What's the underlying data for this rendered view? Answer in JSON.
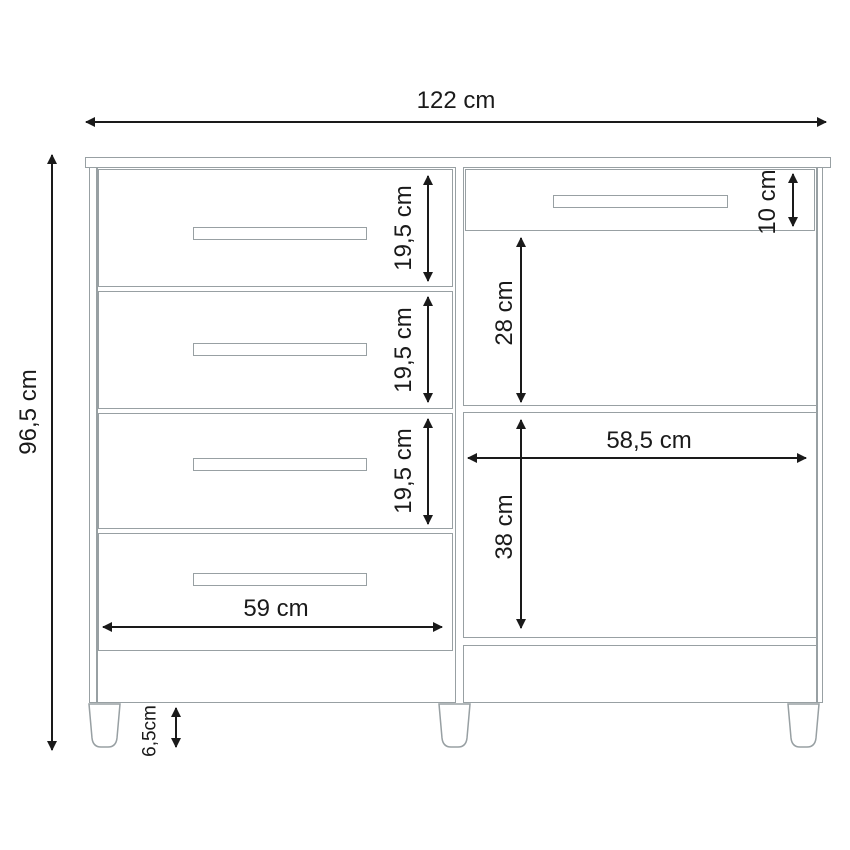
{
  "diagram": {
    "type": "furniture-dimension-drawing",
    "subject": "dresser front elevation with dimensions",
    "unit": "cm",
    "colors": {
      "outline": "#98a0a3",
      "dimension": "#1a1a1a",
      "background": "#ffffff"
    },
    "parts": {
      "left_drawers": 4,
      "right_top_drawers": 1,
      "open_compartments": 2,
      "shelves": 2,
      "feet": 3,
      "handles": 5
    },
    "dimensions": [
      {
        "id": "total-width",
        "label": "122 cm",
        "value": 122,
        "orientation": "horizontal"
      },
      {
        "id": "total-height",
        "label": "96,5 cm",
        "value": 96.5,
        "orientation": "vertical"
      },
      {
        "id": "left-drawer-1-height",
        "label": "19,5 cm",
        "value": 19.5,
        "orientation": "vertical"
      },
      {
        "id": "left-drawer-2-height",
        "label": "19,5 cm",
        "value": 19.5,
        "orientation": "vertical"
      },
      {
        "id": "left-drawer-3-height",
        "label": "19,5 cm",
        "value": 19.5,
        "orientation": "vertical"
      },
      {
        "id": "right-top-drawer-height",
        "label": "10 cm",
        "value": 10,
        "orientation": "vertical"
      },
      {
        "id": "right-upper-compartment-height",
        "label": "28 cm",
        "value": 28,
        "orientation": "vertical"
      },
      {
        "id": "right-section-width",
        "label": "58,5 cm",
        "value": 58.5,
        "orientation": "horizontal"
      },
      {
        "id": "right-lower-compartment-height",
        "label": "38 cm",
        "value": 38,
        "orientation": "vertical"
      },
      {
        "id": "left-drawer-width",
        "label": "59 cm",
        "value": 59,
        "orientation": "horizontal"
      },
      {
        "id": "feet-height",
        "label": "6,5cm",
        "value": 6.5,
        "orientation": "vertical"
      }
    ]
  }
}
